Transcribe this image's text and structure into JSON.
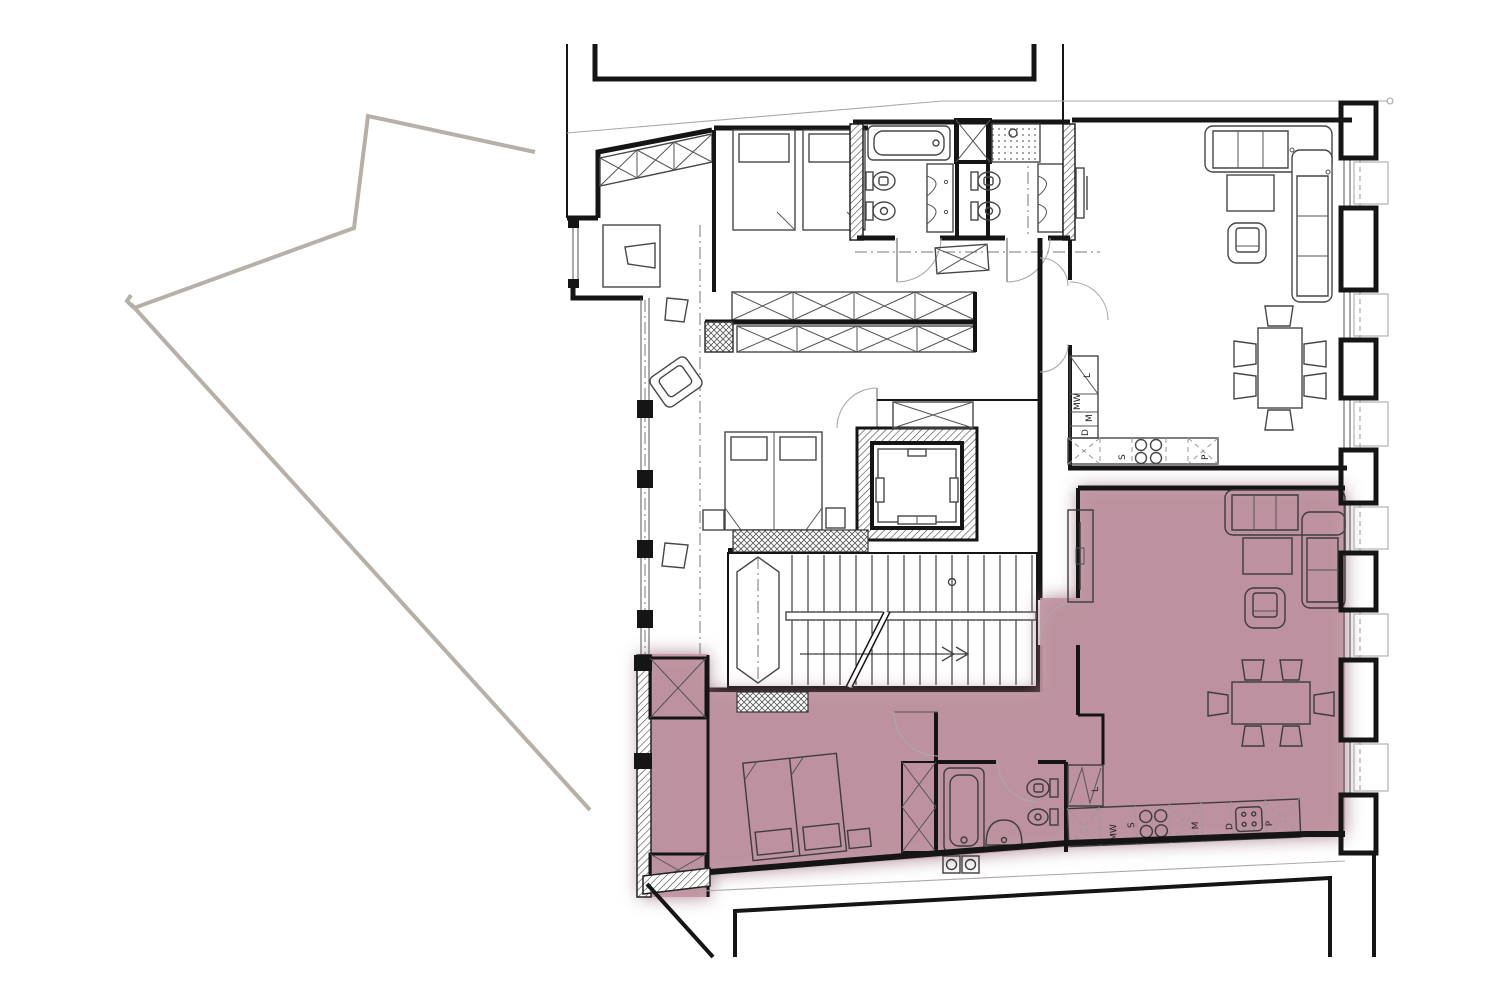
{
  "document": {
    "kind": "architectural-floor-plan",
    "description": "Apartment floor plan with one unit highlighted in pink",
    "background": "#ffffff"
  },
  "colors": {
    "highlight_fill": "#bf93a0",
    "highlight_halo": "#8f5f70",
    "site_boundary": "#b6b0a8",
    "wall_line": "#151515",
    "furniture_line": "#474747",
    "light_line": "#aaaaaa"
  },
  "labels": {
    "kitchen_upper": {
      "tall_unit": "L",
      "microwave": "MW",
      "oven": "M",
      "dishwasher": "D",
      "sink": "S",
      "pantry": "P"
    },
    "kitchen_selected": {
      "tall_unit": "L",
      "microwave": "MW",
      "sink": "S",
      "oven": "M",
      "dishwasher": "D",
      "pantry": "P"
    }
  }
}
